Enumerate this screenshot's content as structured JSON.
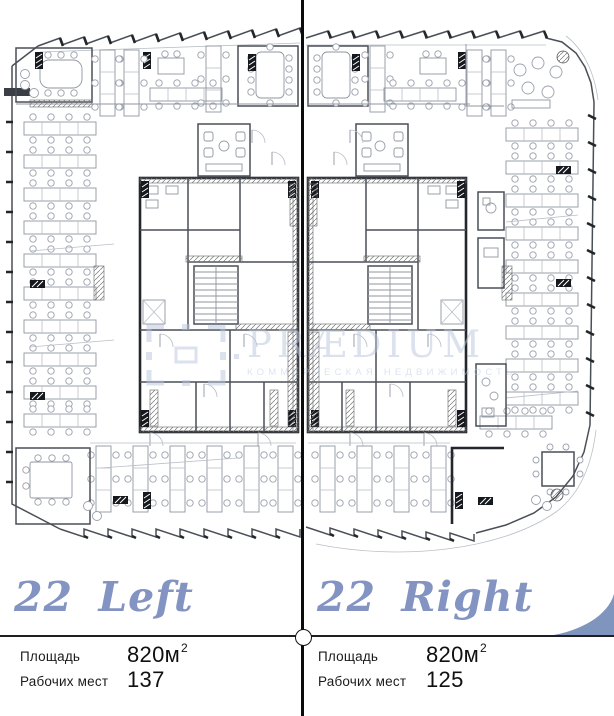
{
  "watermark": {
    "brand": "PRÆDIUM",
    "tagline": "КОММЕРЧЕСКАЯ НЕДВИЖИМОСТЬ"
  },
  "left": {
    "title": "22 Left",
    "area_label": "Площадь",
    "area_value": "820м",
    "area_sup": "2",
    "seats_label": "Рабочих мест",
    "seats_value": "137"
  },
  "right": {
    "title": "22 Right",
    "area_label": "Площадь",
    "area_value": "820м",
    "area_sup": "2",
    "seats_label": "Рабочих мест",
    "seats_value": "125"
  },
  "colors": {
    "accent_blue": "#8494c2",
    "watermark_blue": "#b9c6dd",
    "line_dark": "#1f1f1f"
  }
}
